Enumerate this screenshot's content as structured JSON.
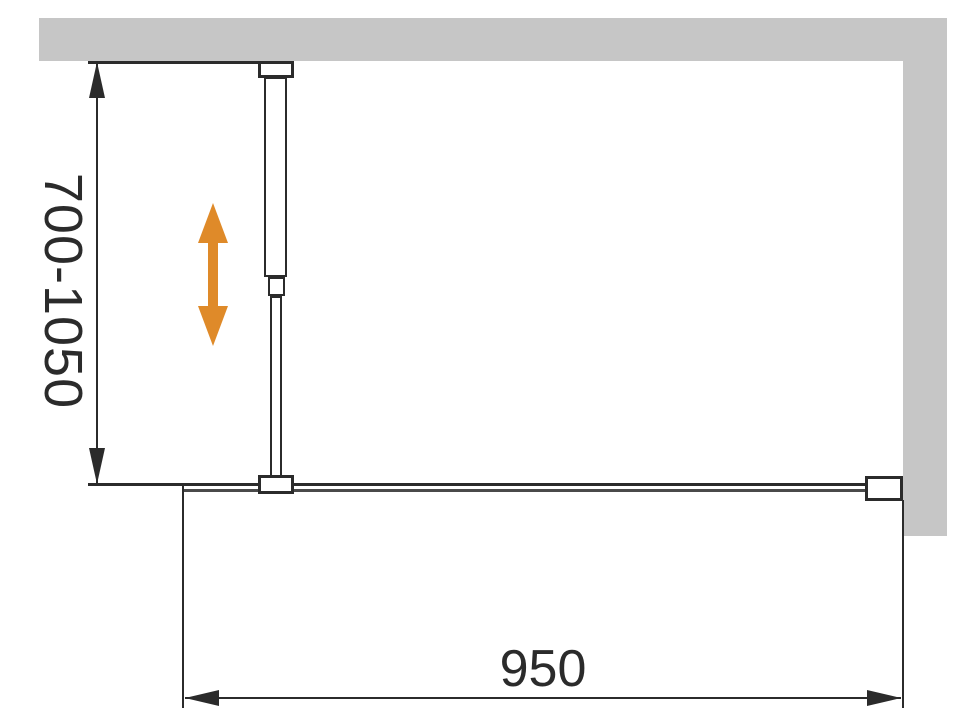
{
  "diagram": {
    "title": "shower-screen-installation-plan-view",
    "labels": {
      "bar_length": "700-1050",
      "panel_width": "950"
    },
    "icons": {
      "adjustability": "double-vertical-arrow-icon"
    },
    "colors": {
      "wall": "#c6c6c6",
      "line": "#2b2b2b",
      "line_soft": "#4a4a4a",
      "accent": "#df8a29",
      "background": "#ffffff"
    }
  }
}
